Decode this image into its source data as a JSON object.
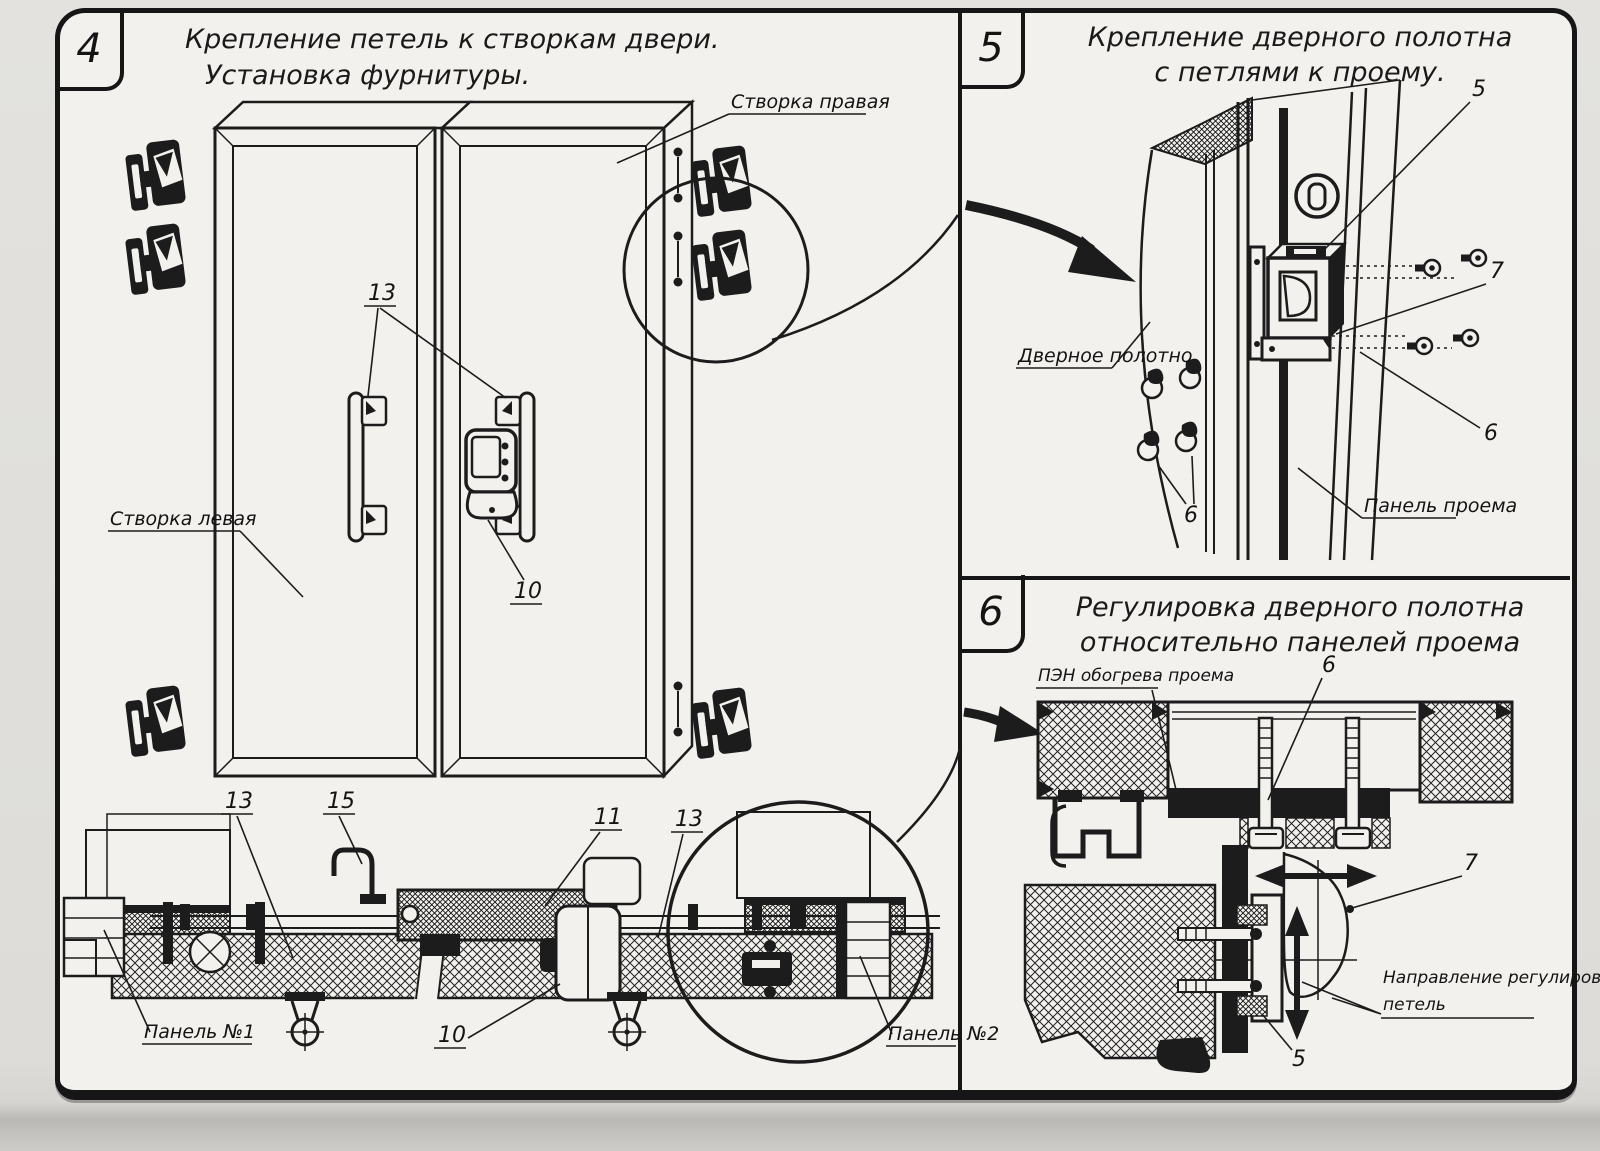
{
  "panels": {
    "p4": {
      "number": "4",
      "title1": "Крепление петель к створкам двери.",
      "title2": "Установка фурнитуры.",
      "labels": {
        "right_leaf": "Створка правая",
        "left_leaf": "Створка левая",
        "c13": "13",
        "c10": "10",
        "sec13": "13",
        "sec15": "15",
        "sec11": "11",
        "sec13b": "13",
        "panel1": "Панель №1",
        "sec10": "10",
        "panel2": "Панель №2"
      }
    },
    "p5": {
      "number": "5",
      "title1": "Крепление дверного полотна",
      "title2": "с петлями к проему.",
      "labels": {
        "c5": "5",
        "c7": "7",
        "c6r": "6",
        "c6l": "6",
        "door_leaf": "Дверное полотно",
        "opening_panel": "Панель проема"
      }
    },
    "p6": {
      "number": "6",
      "title1": "Регулировка дверного полотна",
      "title2": "относительно панелей проема",
      "labels": {
        "heater": "ПЭН обогрева проема",
        "c6": "6",
        "c7": "7",
        "dir1": "Направление регулировки",
        "dir2": "петель",
        "c5": "5"
      }
    },
    "colors": {
      "ink": "#1c1c1c",
      "paper": "#f2f1ed"
    }
  }
}
